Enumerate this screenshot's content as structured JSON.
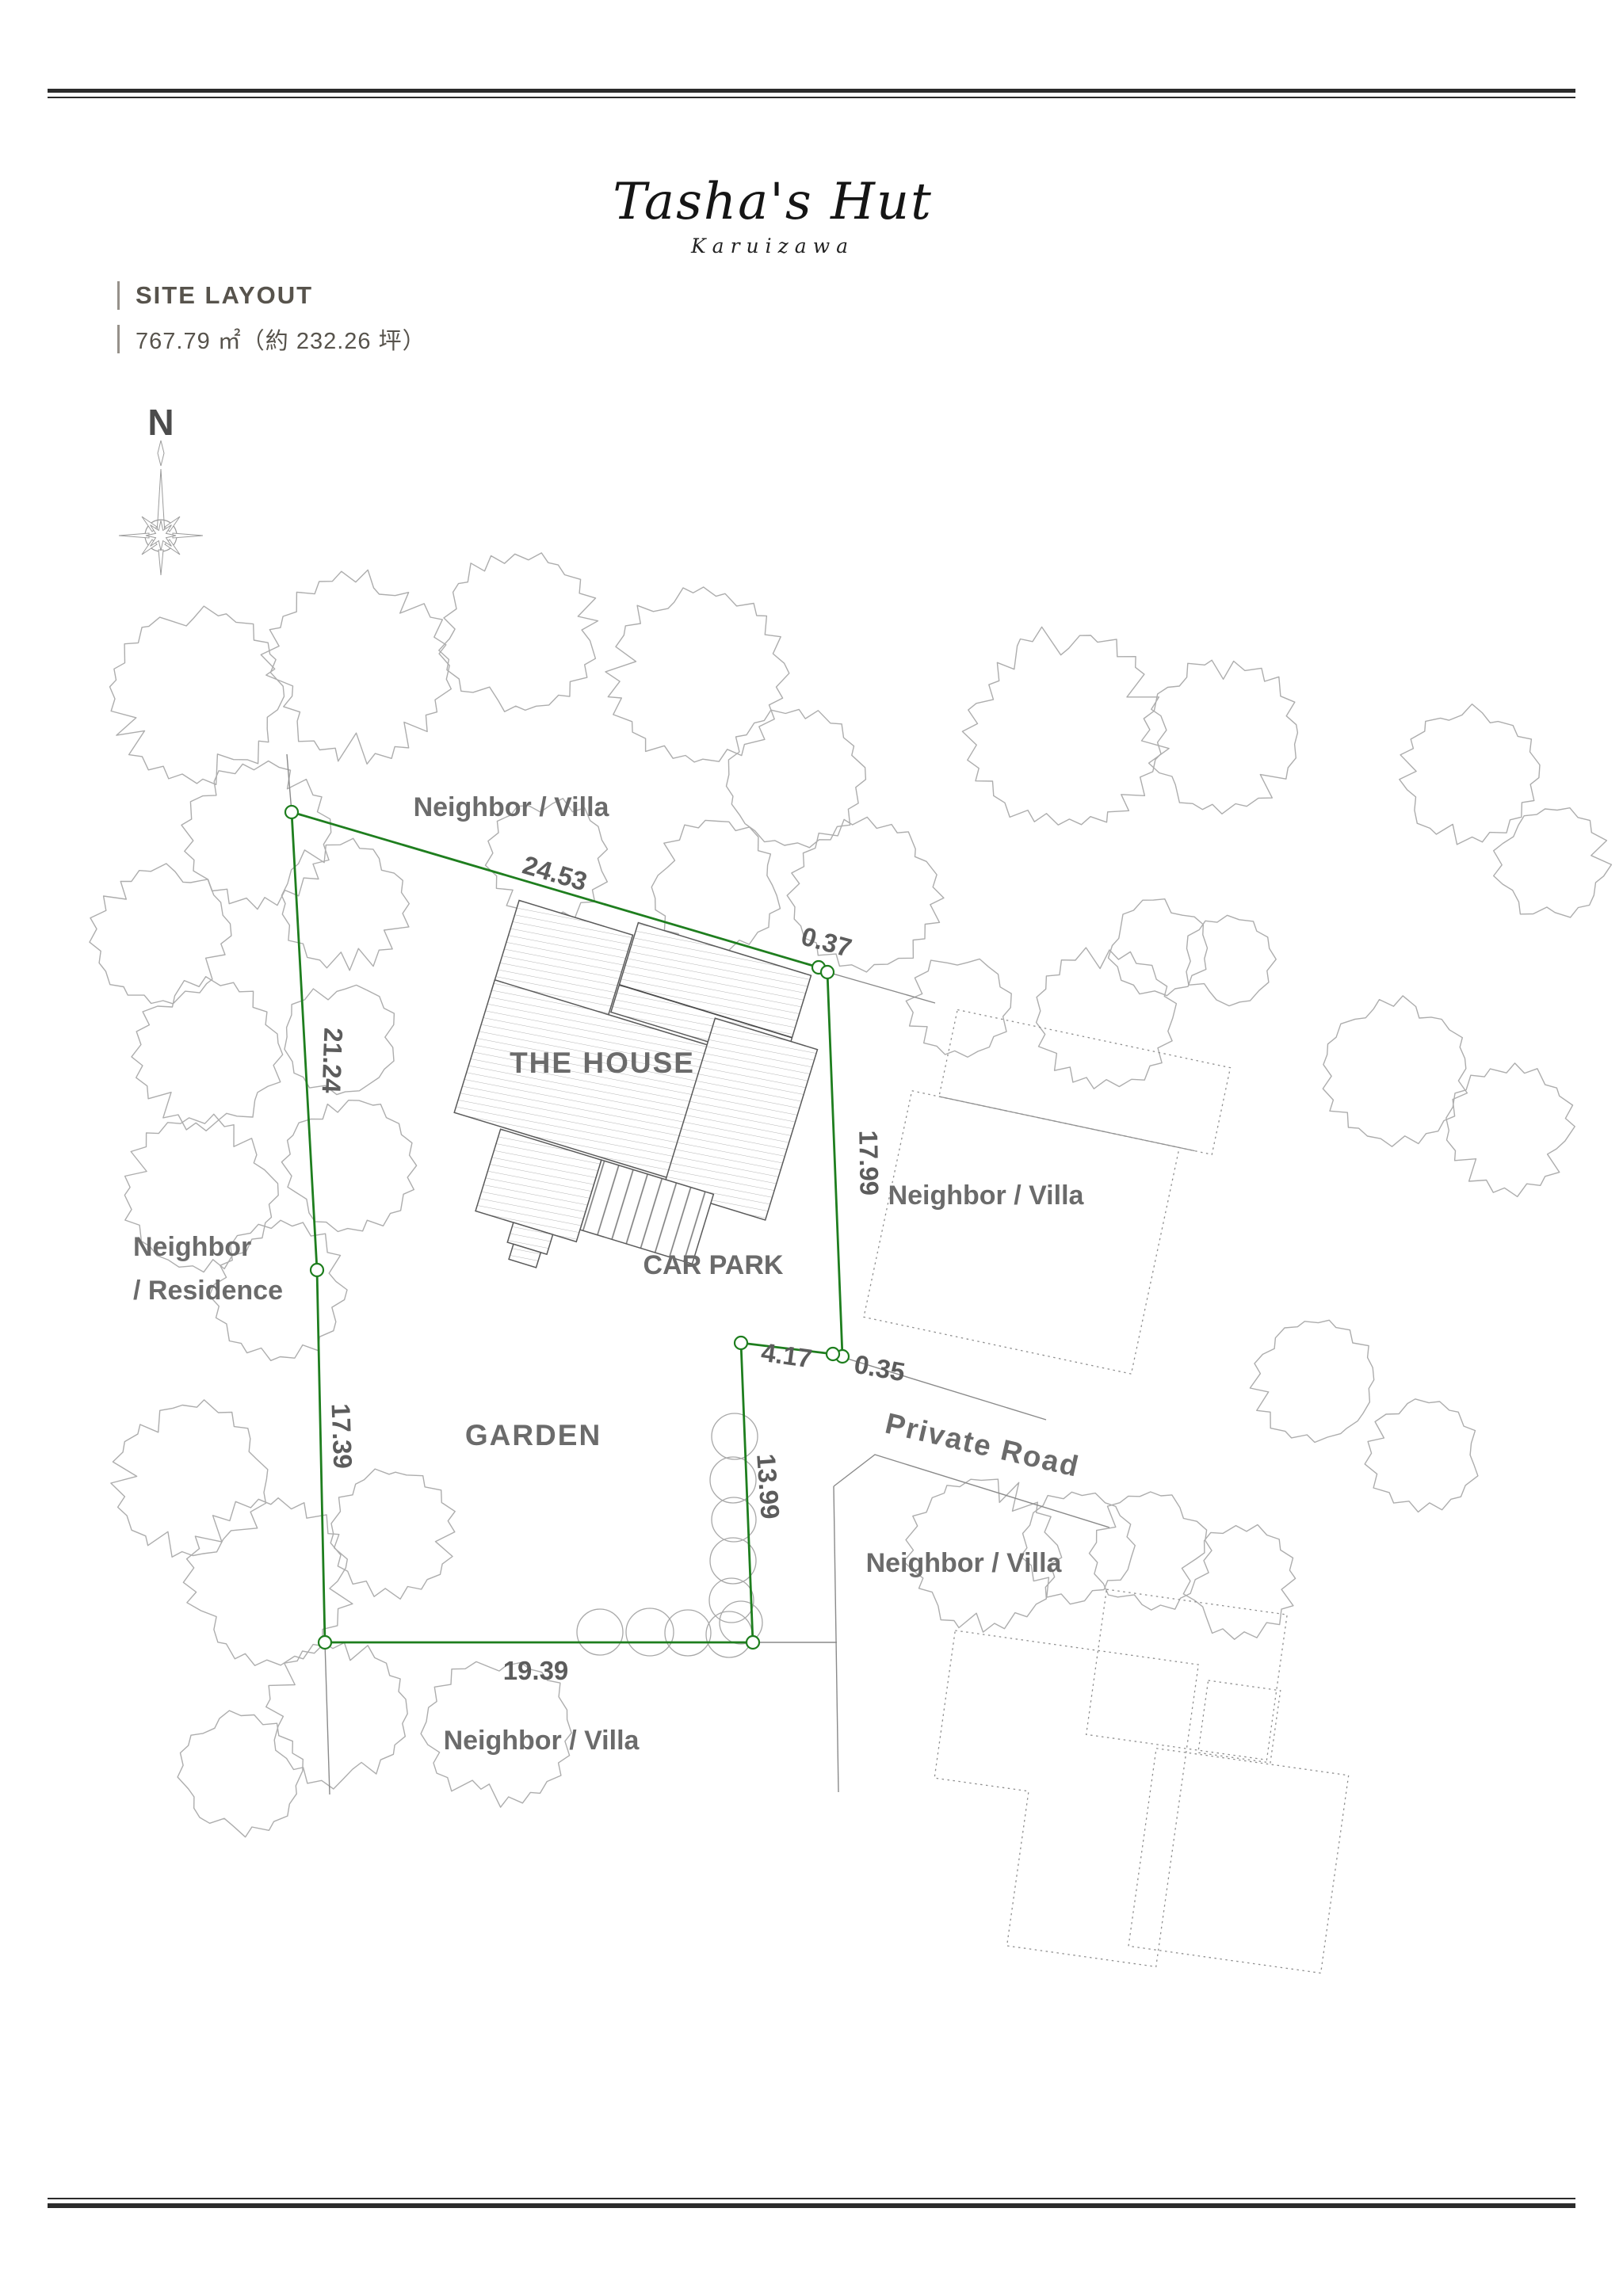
{
  "header": {
    "title": "Tasha's Hut",
    "subtitle": "Karuizawa",
    "section_label": "SITE LAYOUT",
    "area_text": "767.79 ㎡（約 232.26 坪）"
  },
  "compass": {
    "north_label": "N"
  },
  "plan": {
    "site_labels": {
      "house": "THE HOUSE",
      "car_park": "CAR PARK",
      "garden": "GARDEN",
      "private_road": "Private Road"
    },
    "neighbor_labels": {
      "north": "Neighbor / Villa",
      "west_line1": "Neighbor",
      "west_line2": "/ Residence",
      "east": "Neighbor / Villa",
      "road_south": "Neighbor / Villa",
      "south": "Neighbor / Villa"
    },
    "dimensions": {
      "north_edge": "24.53",
      "ne_jog": "0.37",
      "east_edge": "17.99",
      "se_jog": "0.35",
      "carpark_edge": "4.17",
      "lower_east_edge": "13.99",
      "south_edge": "19.39",
      "lower_west_edge": "17.39",
      "upper_west_edge": "21.24"
    },
    "colors": {
      "boundary_green": "#1e7e1e",
      "drawing_gray": "#adadad",
      "label_gray": "#6b6b6b"
    }
  }
}
